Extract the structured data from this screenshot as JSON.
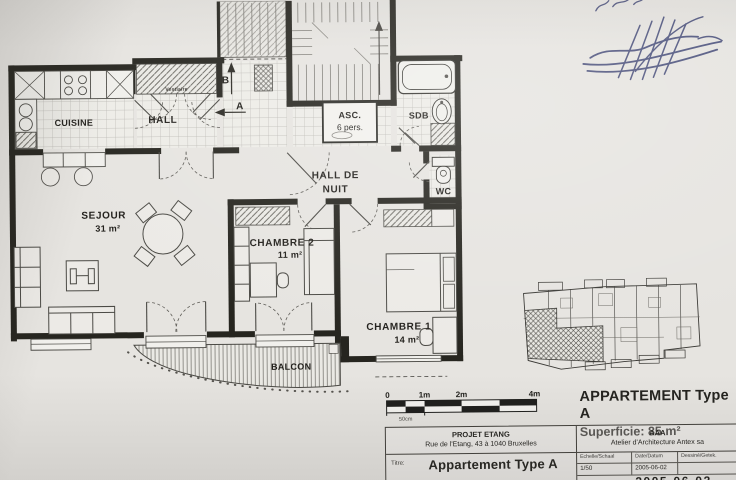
{
  "colors": {
    "paper": "#e6e4e0",
    "ink": "#24231f",
    "signature_ink": "#3a4070"
  },
  "plan": {
    "rooms": {
      "cuisine": {
        "label": "CUISINE"
      },
      "hall": {
        "label": "HALL",
        "closet": "Vestiaire"
      },
      "sejour": {
        "label": "SEJOUR",
        "area": "31 m²"
      },
      "chambre2": {
        "label": "CHAMBRE 2",
        "area": "11 m²"
      },
      "chambre1": {
        "label": "CHAMBRE 1",
        "area": "14 m²"
      },
      "hall_de_nuit": {
        "line1": "HALL DE",
        "line2": "NUIT"
      },
      "sdb": {
        "label": "SDB"
      },
      "wc": {
        "label": "WC"
      },
      "balcon": {
        "label": "BALCON"
      },
      "ascenseur": {
        "line1": "ASC.",
        "line2": "6 pers."
      }
    },
    "markers": {
      "a": "A",
      "b": "B"
    }
  },
  "scalebar": {
    "ticks": [
      "0",
      "1m",
      "2m",
      "4m"
    ],
    "sub": "50cm"
  },
  "summary": {
    "title": "APPARTEMENT Type A",
    "subtitle": "Superficie: 85 m²"
  },
  "titleblock": {
    "project": "PROJET ETANG",
    "address": "Rue de l'Etang, 43 à 1040 Bruxelles",
    "titre_label": "Titre:",
    "titre_value": "Appartement Type A",
    "firm_short": "AAA",
    "firm": "Atelier d'Architecture Antex sa",
    "scale_label": "Echelle/Schaal",
    "scale_value": "1/50",
    "date_label": "Date/Datum",
    "date_value": "2005-06-02",
    "drawn_label": "Dessiné/Getek.",
    "footer_partial": "2005-06-02"
  }
}
